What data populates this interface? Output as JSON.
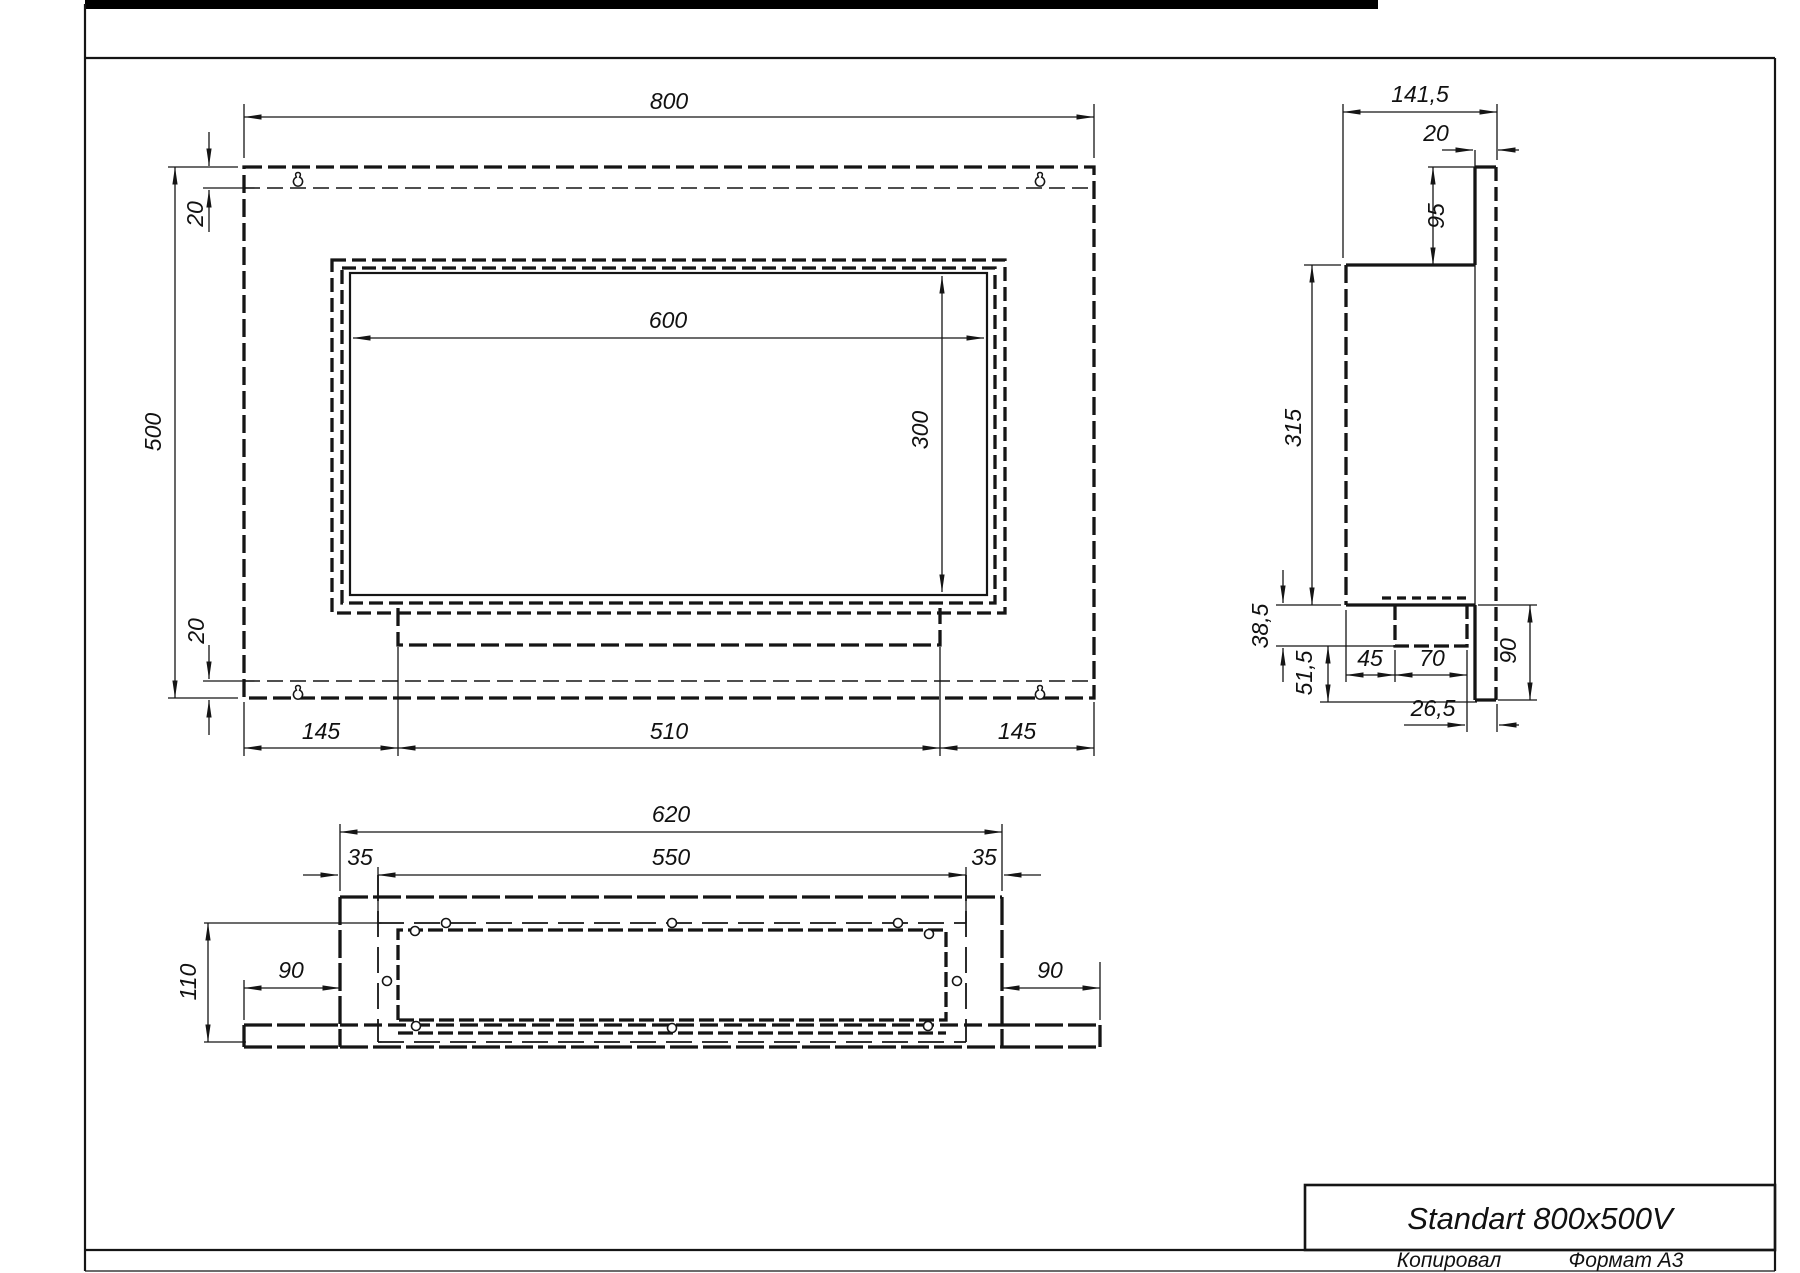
{
  "sheet": {
    "title_block": {
      "model": "Standart 800x500V"
    },
    "footer": {
      "copied_by": "Копировал",
      "format": "Формат А3"
    }
  },
  "front_view": {
    "overall_width": "800",
    "overall_height": "500",
    "top_flange": "20",
    "bottom_flange": "20",
    "opening_width": "600",
    "opening_height": "300",
    "left_offset": "145",
    "tray_width": "510",
    "right_offset": "145"
  },
  "side_view": {
    "overall_depth": "141,5",
    "plate_thickness": "20",
    "top_drop": "95",
    "body_height": "315",
    "tray_height": "38,5",
    "bottom_clearance": "51,5",
    "tray_offset": "45",
    "tray_depth": "70",
    "plate_bottom_drop": "90",
    "front_lip": "26,5"
  },
  "bottom_view": {
    "body_width": "620",
    "niche_width": "550",
    "left_inset": "35",
    "right_inset": "35",
    "depth": "110",
    "left_wing": "90",
    "right_wing": "90"
  }
}
